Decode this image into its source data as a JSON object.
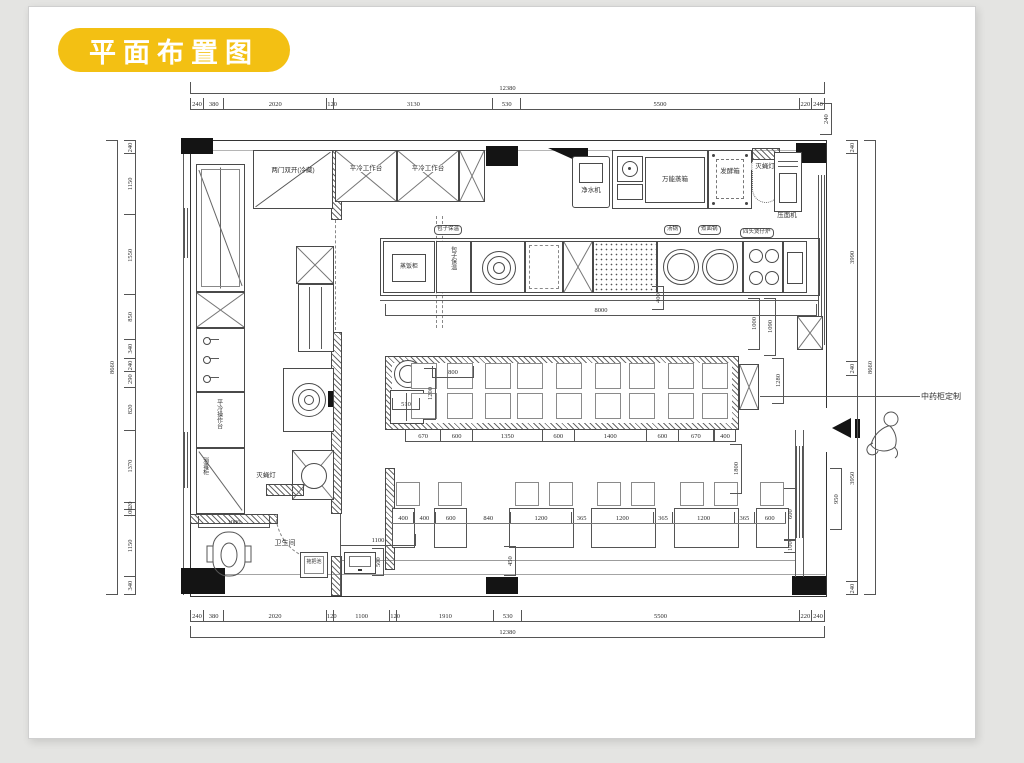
{
  "title": {
    "badge": "平面布置图"
  },
  "colors": {
    "badge_bg": "#F3C013",
    "line": "#4a4a4a"
  },
  "labels": {
    "fridge_double": "两门双开(冷藏)",
    "cold_table_a": "平冷工作台",
    "cold_table_b": "平冷工作台",
    "water_purifier": "净水机",
    "combi_oven": "万能蒸箱",
    "proofer": "发酵箱",
    "fly_lamp_top": "灭蝇灯",
    "noodle_press": "压面机",
    "steam_cabinet": "蒸饭柜",
    "bun_warmer": "包子保温",
    "soup_pot": "汤锅",
    "noodle_pot": "煮面锅",
    "clay_pot_stove": "四头煲仔炉",
    "cold_counter": "平冷操作台",
    "sterilizer": "消毒柜",
    "fly_lamp_left": "灭蝇灯",
    "toilet": "卫生间",
    "mop_sink": "拖把池",
    "herb_cabinet_note": "中药柜定制"
  },
  "dims": {
    "top_total": [
      {
        "v": 12380,
        "t": "12380"
      }
    ],
    "top": [
      {
        "v": 240,
        "t": "240"
      },
      {
        "v": 380,
        "t": "380"
      },
      {
        "v": 2020,
        "t": "2020"
      },
      {
        "v": 120,
        "t": "120"
      },
      {
        "v": 3130,
        "t": "3130"
      },
      {
        "v": 530,
        "t": "530"
      },
      {
        "v": 5500,
        "t": "5500"
      },
      {
        "v": 220,
        "t": "220"
      },
      {
        "v": 240,
        "t": "240"
      }
    ],
    "bottom": [
      {
        "v": 240,
        "t": "240"
      },
      {
        "v": 380,
        "t": "380"
      },
      {
        "v": 2020,
        "t": "2020"
      },
      {
        "v": 120,
        "t": "120"
      },
      {
        "v": 1100,
        "t": "1100"
      },
      {
        "v": 120,
        "t": "120"
      },
      {
        "v": 1910,
        "t": "1910"
      },
      {
        "v": 530,
        "t": "530"
      },
      {
        "v": 5500,
        "t": "5500"
      },
      {
        "v": 220,
        "t": "220"
      },
      {
        "v": 240,
        "t": "240"
      }
    ],
    "bottom_total": [
      {
        "v": 12380,
        "t": "12380"
      }
    ],
    "left_total": [
      {
        "v": 8660,
        "t": "8660"
      }
    ],
    "left": [
      {
        "v": 240,
        "t": "240"
      },
      {
        "v": 1150,
        "t": "1150"
      },
      {
        "v": 1550,
        "t": "1550"
      },
      {
        "v": 850,
        "t": "850"
      },
      {
        "v": 340,
        "t": "340"
      },
      {
        "v": 240,
        "t": "240"
      },
      {
        "v": 290,
        "t": "290"
      },
      {
        "v": 820,
        "t": "820"
      },
      {
        "v": 1370,
        "t": "1370"
      },
      {
        "v": 120,
        "t": "120"
      },
      {
        "v": 100,
        "t": "100"
      },
      {
        "v": 1150,
        "t": "1150"
      },
      {
        "v": 340,
        "t": "340"
      }
    ],
    "right": [
      {
        "v": 240,
        "t": "240"
      },
      {
        "v": 3990,
        "t": "3990"
      },
      {
        "v": 240,
        "t": "240"
      },
      {
        "v": 3950,
        "t": "3950"
      },
      {
        "v": 240,
        "t": "240"
      }
    ],
    "right_total": [
      {
        "v": 8660,
        "t": "8660"
      }
    ],
    "corner240": [
      {
        "v": 240,
        "t": "240"
      }
    ],
    "cook_len": [
      {
        "v": 8000,
        "t": "8000"
      }
    ],
    "v400": [
      {
        "v": 400,
        "t": "400"
      }
    ],
    "v1000": [
      {
        "v": 1000,
        "t": "1000"
      }
    ],
    "v1090": [
      {
        "v": 1090,
        "t": "1090"
      }
    ],
    "v1280": [
      {
        "v": 1280,
        "t": "1280"
      }
    ],
    "h800": [
      {
        "v": 800,
        "t": "800"
      }
    ],
    "v1200": [
      {
        "v": 1200,
        "t": "1200"
      }
    ],
    "counter": [
      {
        "v": 670,
        "t": "670"
      },
      {
        "v": 600,
        "t": "600"
      },
      {
        "v": 1350,
        "t": "1350"
      },
      {
        "v": 600,
        "t": "600"
      },
      {
        "v": 1400,
        "t": "1400"
      },
      {
        "v": 600,
        "t": "600"
      },
      {
        "v": 670,
        "t": "670"
      }
    ],
    "dim400r": [
      {
        "v": 400,
        "t": "400"
      }
    ],
    "v1800": [
      {
        "v": 1800,
        "t": "1800"
      }
    ],
    "tables": [
      {
        "v": 400,
        "t": "400"
      },
      {
        "v": 400,
        "t": "400"
      },
      {
        "v": 600,
        "t": "600"
      },
      {
        "v": 840,
        "t": "840"
      },
      {
        "v": 1200,
        "t": "1200"
      },
      {
        "v": 365,
        "t": "365"
      },
      {
        "v": 1200,
        "t": "1200"
      },
      {
        "v": 365,
        "t": "365"
      },
      {
        "v": 1200,
        "t": "1200"
      },
      {
        "v": 365,
        "t": "365"
      },
      {
        "v": 600,
        "t": "600"
      }
    ],
    "v450": [
      {
        "v": 450,
        "t": "450"
      }
    ],
    "h1100": [
      {
        "v": 1100,
        "t": "1100"
      }
    ],
    "v500": [
      {
        "v": 500,
        "t": "500"
      }
    ],
    "toilet_w": [
      {
        "v": 1000,
        "t": "1000"
      }
    ],
    "cab510": [
      {
        "v": 510,
        "t": "510"
      }
    ],
    "v600": [
      {
        "v": 600,
        "t": "600"
      }
    ],
    "v100": [
      {
        "v": 100,
        "t": "100"
      }
    ],
    "v950": [
      {
        "v": 950,
        "t": "950"
      }
    ]
  }
}
